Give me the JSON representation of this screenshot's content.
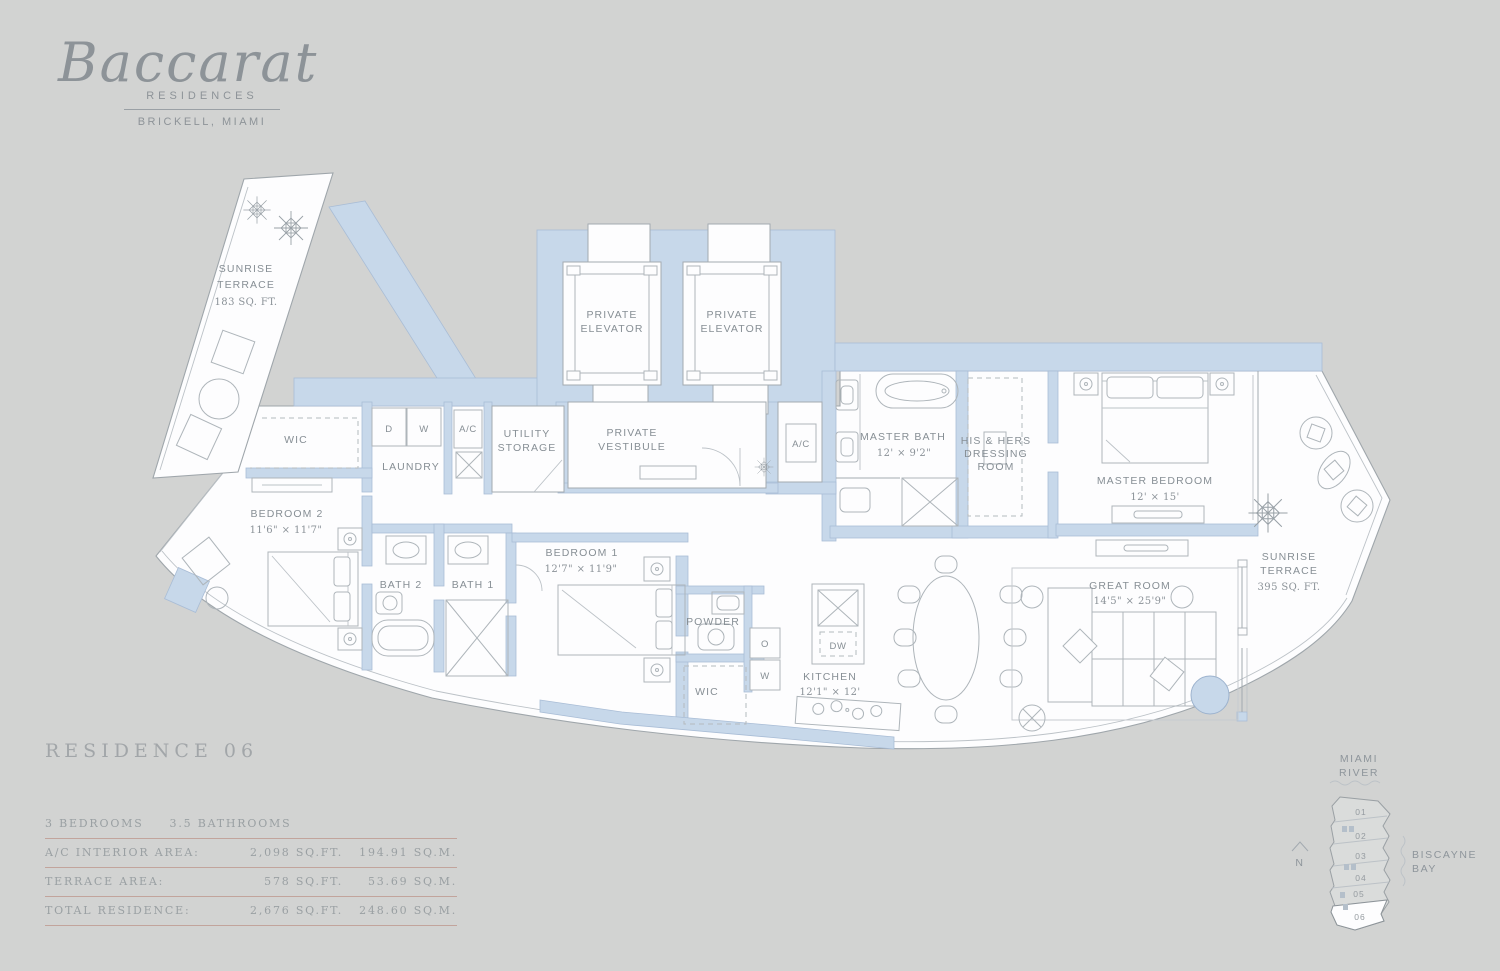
{
  "brand": {
    "name": "Baccarat",
    "sub": "RESIDENCES",
    "location": "BRICKELL, MIAMI"
  },
  "plan": {
    "rooms": {
      "terrace_nw": {
        "l1": "SUNRISE",
        "l2": "TERRACE",
        "l3": "183 SQ. FT."
      },
      "elevator1": {
        "l1": "PRIVATE",
        "l2": "ELEVATOR"
      },
      "elevator2": {
        "l1": "PRIVATE",
        "l2": "ELEVATOR"
      },
      "wic1": {
        "name": "WIC"
      },
      "dryer": {
        "name": "D"
      },
      "washer": {
        "name": "W"
      },
      "laundry": {
        "name": "LAUNDRY"
      },
      "ac1": {
        "name": "A/C"
      },
      "utility": {
        "l1": "UTILITY",
        "l2": "STORAGE"
      },
      "vestibule": {
        "l1": "PRIVATE",
        "l2": "VESTIBULE"
      },
      "ac2": {
        "name": "A/C"
      },
      "master_bath": {
        "name": "MASTER BATH",
        "dims": "12' × 9'2\""
      },
      "dressing": {
        "l1": "HIS & HERS",
        "l2": "DRESSING",
        "l3": "ROOM"
      },
      "master_bedroom": {
        "name": "MASTER BEDROOM",
        "dims": "12' × 15'"
      },
      "terrace_e": {
        "l1": "SUNRISE",
        "l2": "TERRACE",
        "l3": "395 SQ. FT."
      },
      "bedroom2": {
        "name": "BEDROOM 2",
        "dims": "11'6\" × 11'7\""
      },
      "bath2": {
        "name": "BATH 2"
      },
      "bath1": {
        "name": "BATH 1"
      },
      "bedroom1": {
        "name": "BEDROOM 1",
        "dims": "12'7\" × 11'9\""
      },
      "powder": {
        "name": "POWDER"
      },
      "oven": {
        "name": "O"
      },
      "warming": {
        "name": "W"
      },
      "dw": {
        "name": "DW"
      },
      "wic2": {
        "name": "WIC"
      },
      "kitchen": {
        "name": "KITCHEN",
        "dims": "12'1\" × 12'"
      },
      "great_room": {
        "name": "GREAT ROOM",
        "dims": "14'5\" × 25'9\""
      }
    }
  },
  "info": {
    "residence_title": "RESIDENCE 06",
    "bedrooms": "3 BEDROOMS",
    "bathrooms": "3.5 BATHROOMS",
    "rows": [
      {
        "label": "A/C INTERIOR AREA:",
        "sqft": "2,098 SQ.FT.",
        "sqm": "194.91 SQ.M."
      },
      {
        "label": "TERRACE AREA:",
        "sqft": "578 SQ.FT.",
        "sqm": "53.69 SQ.M."
      },
      {
        "label": "TOTAL RESIDENCE:",
        "sqft": "2,676 SQ.FT.",
        "sqm": "248.60 SQ.M."
      }
    ]
  },
  "keyplan": {
    "river_l1": "MIAMI",
    "river_l2": "RIVER",
    "bay_l1": "BISCAYNE",
    "bay_l2": "BAY",
    "north": "N",
    "units": [
      "01",
      "02",
      "03",
      "04",
      "05",
      "06"
    ],
    "highlight_unit": "06"
  },
  "colors": {
    "background": "#d2d3d2",
    "wall_blue": "#c7d8ea",
    "line_gray": "#a3aab0",
    "label_gray": "#878f95",
    "rule_red": "#c2a49c"
  }
}
